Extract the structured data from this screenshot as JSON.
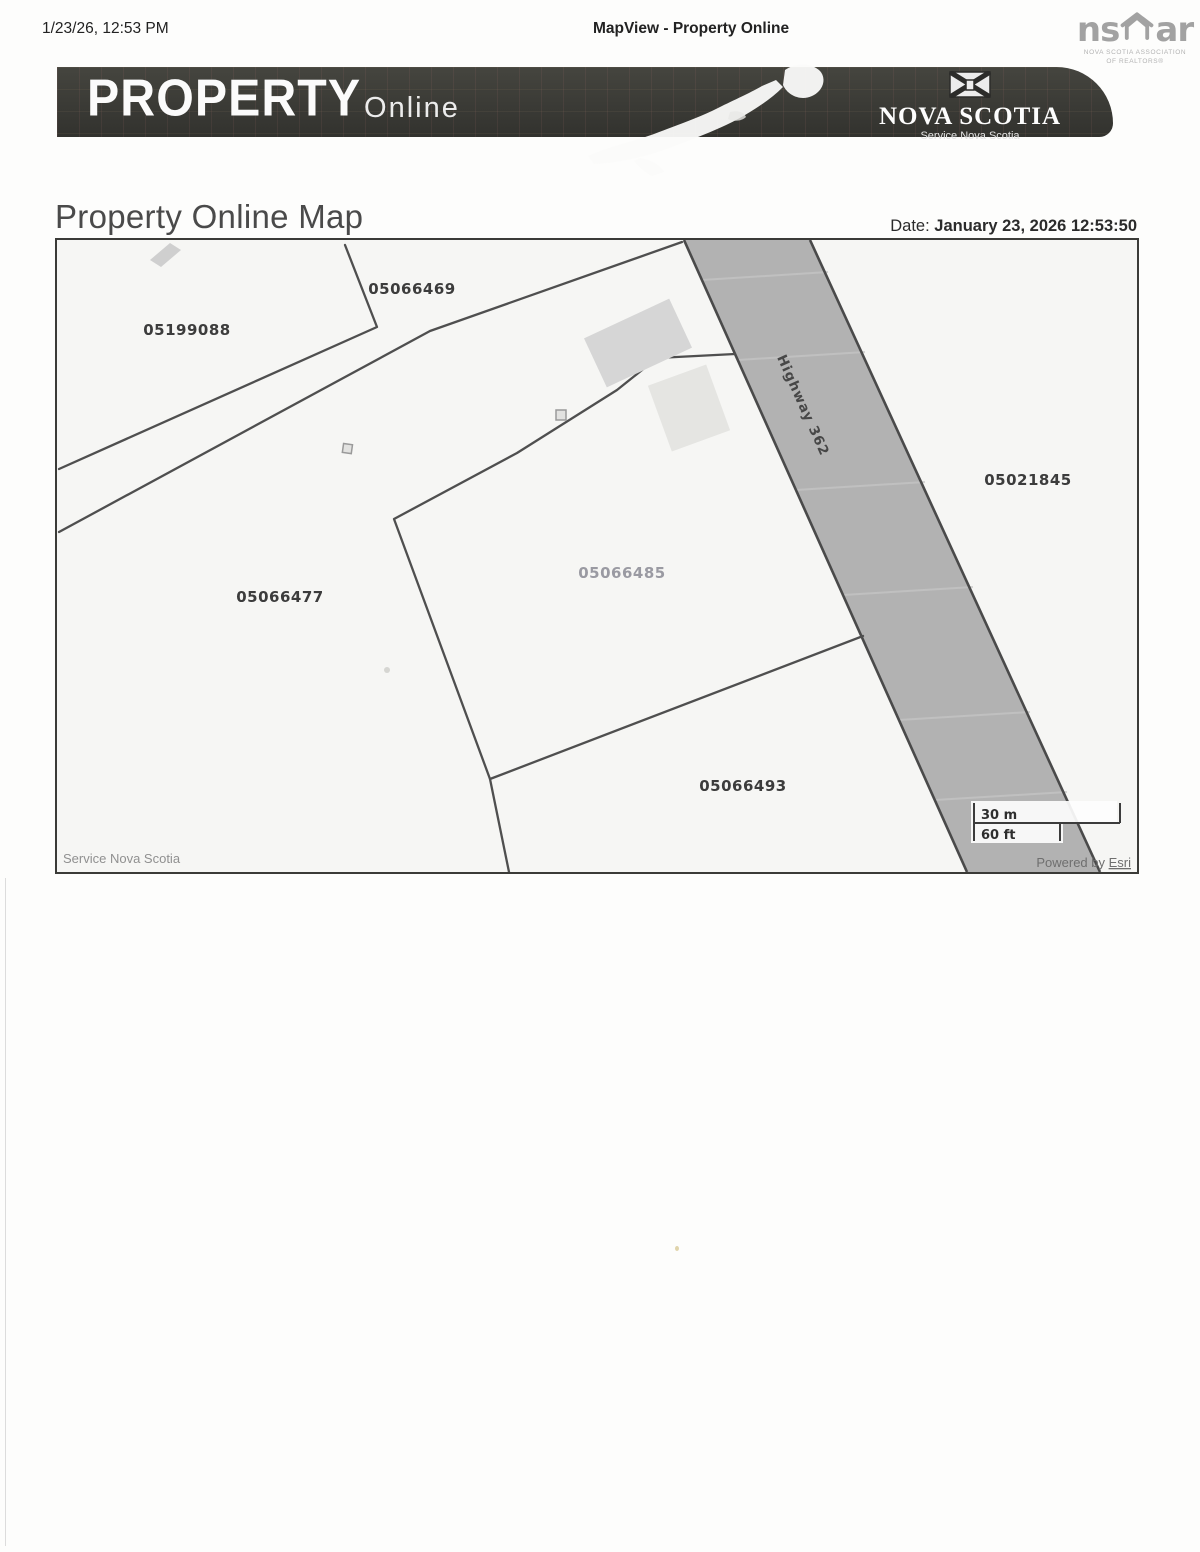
{
  "page": {
    "print_header": {
      "left": "1/23/26, 12:53 PM",
      "center": "MapView - Property Online"
    },
    "nsar": {
      "ns": "ns",
      "ar": "ar",
      "caption1": "NOVA SCOTIA ASSOCIATION",
      "caption2": "OF REALTORS®"
    },
    "banner": {
      "title": "PROPERTY",
      "subtitle": "Online",
      "org": "NOVA SCOTIA",
      "org_sub": "Service Nova Scotia"
    },
    "title": "Property Online Map",
    "date": {
      "label": "Date:",
      "value": "January 23, 2026 12:53:50"
    }
  },
  "map": {
    "road_label": "Highway 362",
    "parcels": [
      {
        "pid": "05199088",
        "highlight": false
      },
      {
        "pid": "05066469",
        "highlight": false
      },
      {
        "pid": "05021845",
        "highlight": false
      },
      {
        "pid": "05066477",
        "highlight": false
      },
      {
        "pid": "05066485",
        "highlight": true
      },
      {
        "pid": "05066493",
        "highlight": false
      }
    ],
    "scalebar": {
      "metric": "30 m",
      "imperial": "60 ft"
    },
    "attribution": {
      "left": "Service Nova Scotia",
      "powered_prefix": "Powered by ",
      "powered_link": "Esri"
    }
  },
  "colors": {
    "highway_fill": "#b2b2b2",
    "parcel_line": "#4f4f4f",
    "banner_bg": "#3a3a38",
    "label": "#3c3c3c",
    "highlight_label": "#9a9aa2"
  }
}
